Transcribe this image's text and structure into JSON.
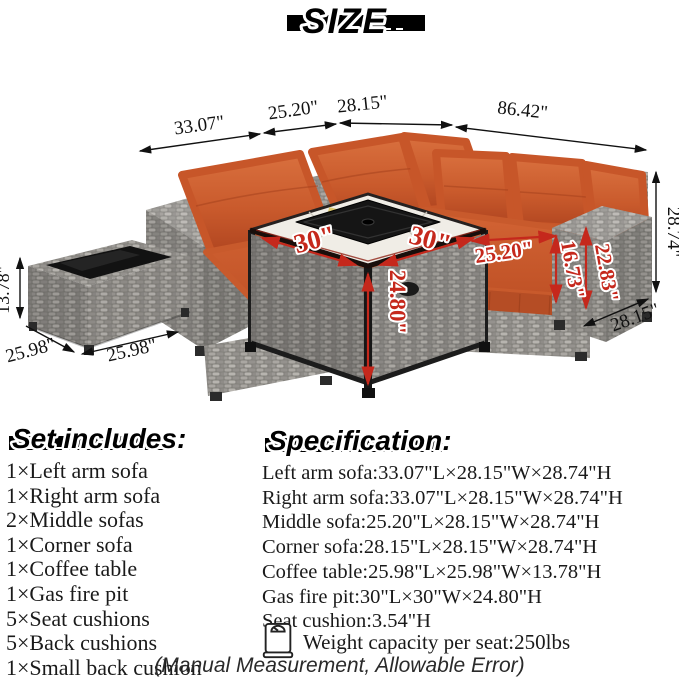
{
  "title": "SIZE",
  "colors": {
    "cushion_orange": "#c75629",
    "dimension_red": "#c5281c",
    "wicker_gray": "#928f8b",
    "text_black": "#111111"
  },
  "diagram": {
    "top_dims": [
      "33.07\"",
      "25.20\"",
      "28.15\"",
      "86.42\""
    ],
    "right_height": "28.74\"",
    "right_depth": "28.15\"",
    "coffee_table_height": "13.78\"",
    "coffee_table_side": "25.98\"",
    "coffee_table_front": "25.98\"",
    "firepit_left_edge": "30\"",
    "firepit_right_edge": "30\"",
    "firepit_height": "24.80\"",
    "seat_length": "25.20\"",
    "arm_inner_height": "16.73\"",
    "arm_outer_height": "22.83\""
  },
  "set_includes": {
    "heading": "Set includes:",
    "items": [
      "1×Left arm sofa",
      "1×Right arm sofa",
      "2×Middle sofas",
      "1×Corner sofa",
      "1×Coffee table",
      "1×Gas fire pit",
      "5×Seat cushions",
      "5×Back cushions",
      "1×Small back cushion"
    ]
  },
  "specification": {
    "heading": "Specification:",
    "items": [
      "Left arm sofa:33.07\"L×28.15\"W×28.74\"H",
      "Right arm sofa:33.07\"L×28.15\"W×28.74\"H",
      "Middle sofa:25.20\"L×28.15\"W×28.74\"H",
      "Corner sofa:28.15\"L×28.15\"W×28.74\"H",
      "Coffee table:25.98\"L×25.98\"W×13.78\"H",
      "Gas fire pit:30\"L×30\"W×24.80\"H",
      "Seat cushion:3.54\"H"
    ],
    "weight_note": "Weight capacity per seat:250lbs"
  },
  "footer": "(Manual Measurement, Allowable Error)"
}
